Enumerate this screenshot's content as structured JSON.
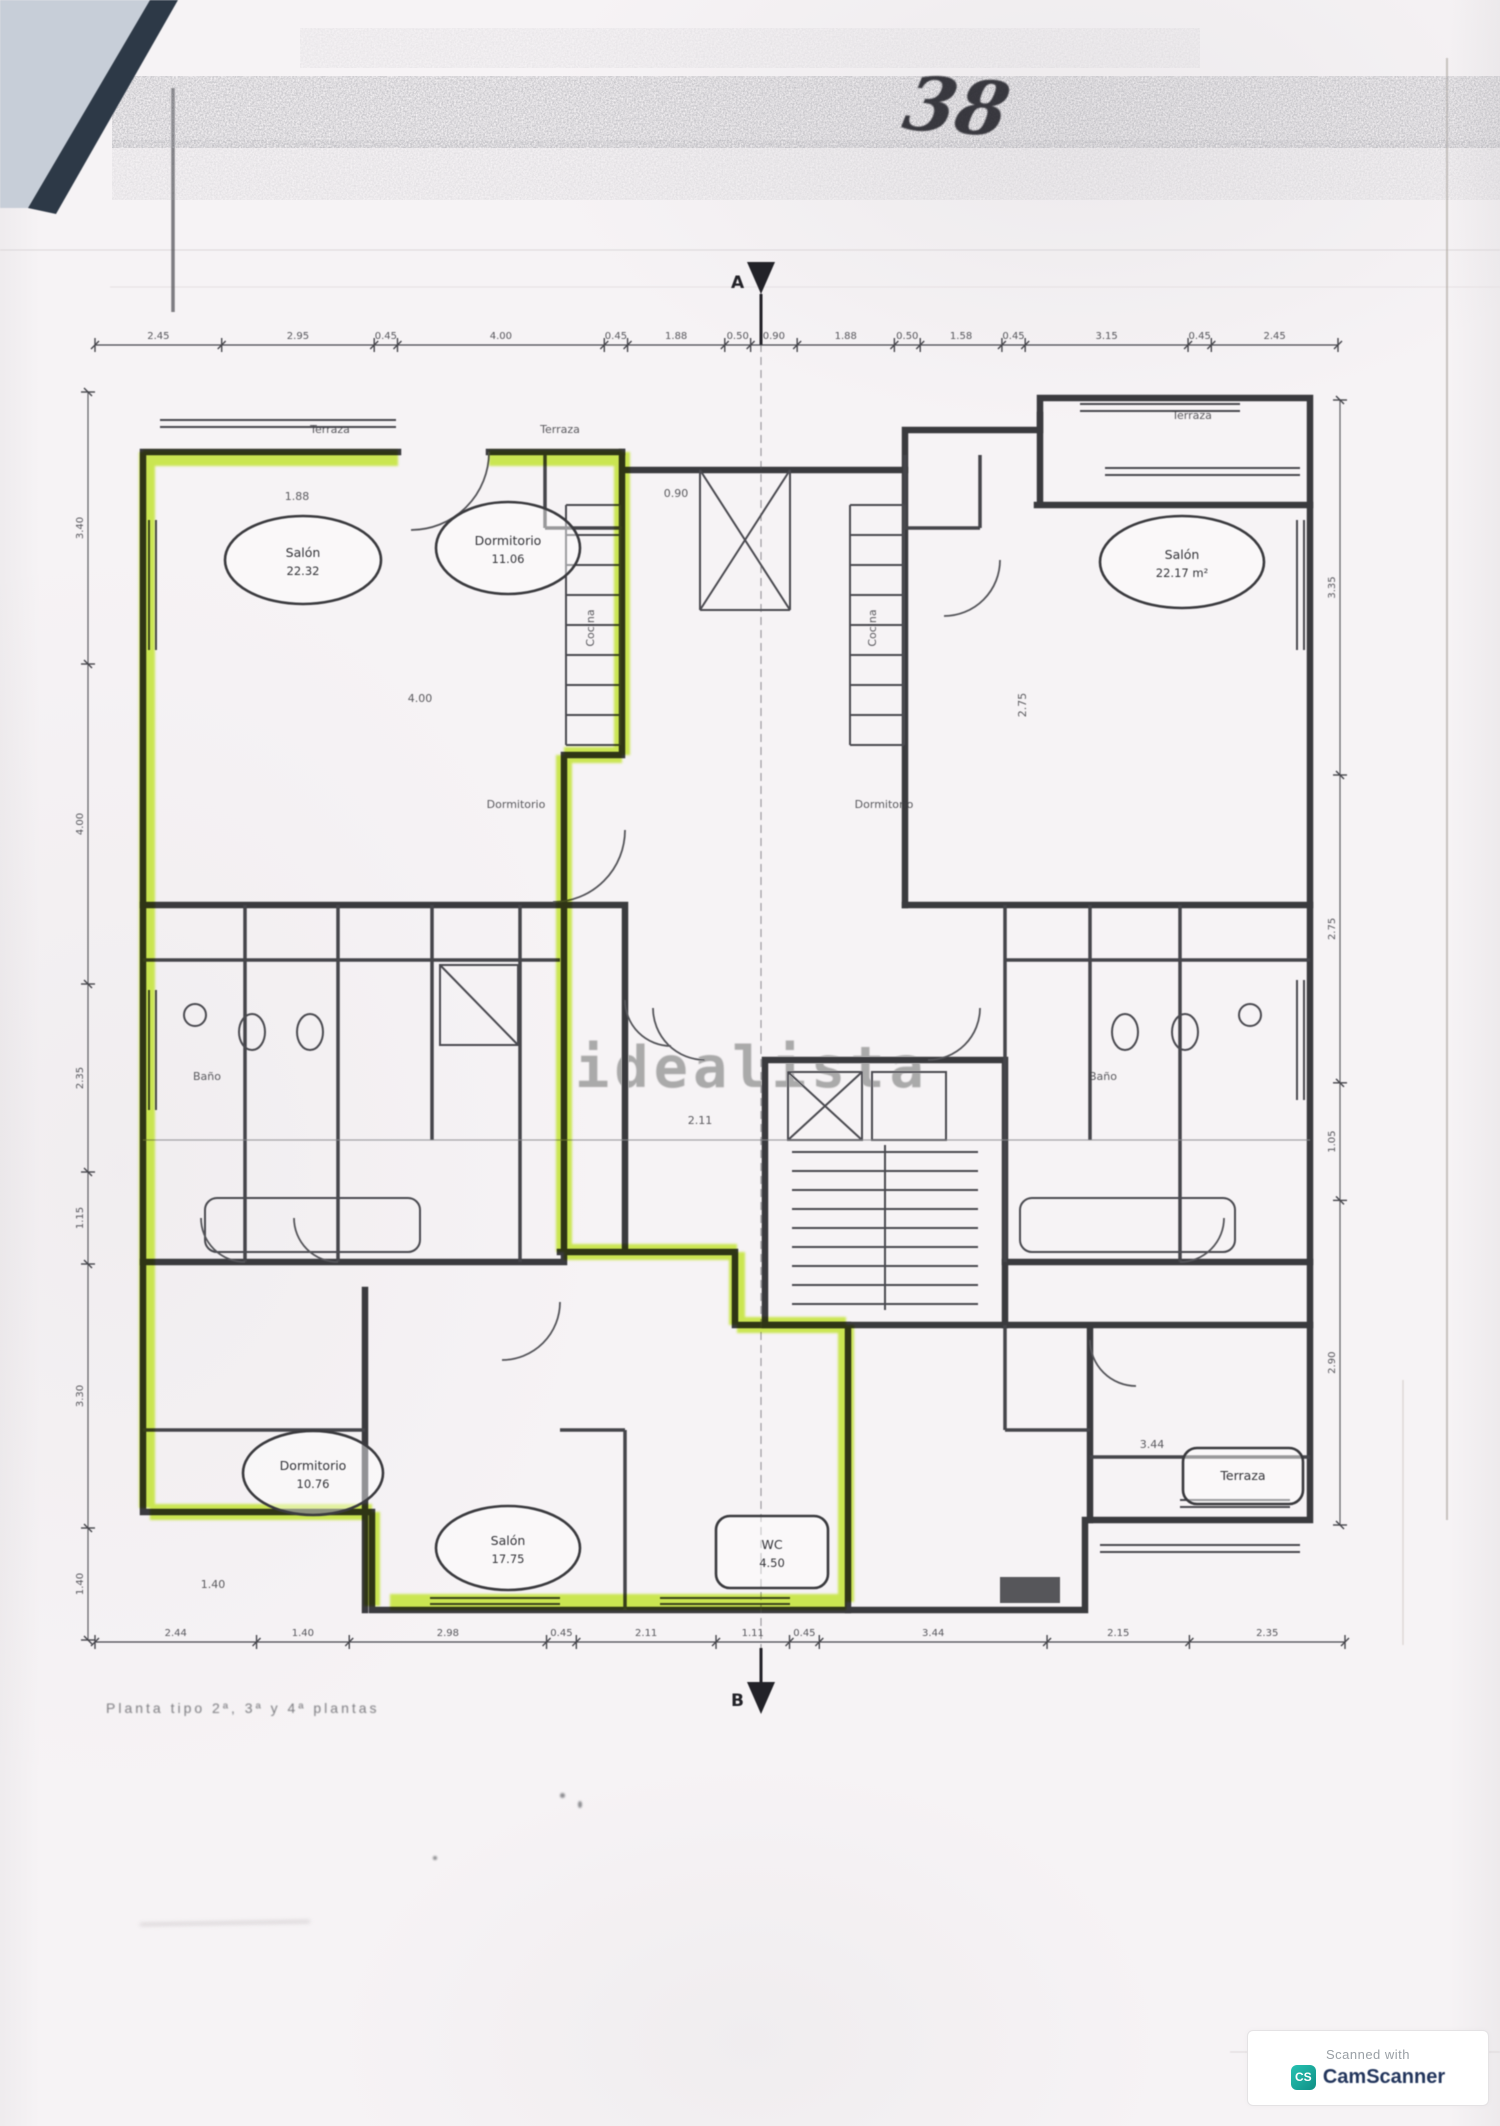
{
  "document": {
    "handwritten_mark": "38",
    "watermark": "idealista",
    "caption": "Planta tipo 2ª, 3ª y 4ª plantas",
    "section_markers": {
      "top": "A",
      "bottom": "B"
    },
    "scan_badge": {
      "prefix": "Scanned with",
      "app": "CamScanner",
      "monogram": "CS"
    }
  },
  "colors": {
    "paper": "#f6f3f5",
    "ink": "#3a3a3e",
    "highlighter": "#bfe227",
    "watermark_gray": "#9c9c9c",
    "fold_dark": "#2d3947",
    "fold_light": "#c7ced8",
    "badge_teal": "#14a79d",
    "badge_navy": "#22355c"
  },
  "plan": {
    "rooms": [
      {
        "label": "Salón",
        "area": "22.32",
        "cx": 303,
        "cy": 560,
        "rx": 78,
        "ry": 44,
        "shape": "oval"
      },
      {
        "label": "Dormitorio",
        "area": "11.06",
        "cx": 508,
        "cy": 548,
        "rx": 72,
        "ry": 46,
        "shape": "oval"
      },
      {
        "label": "Salón",
        "area": "22.17 m²",
        "cx": 1182,
        "cy": 562,
        "rx": 82,
        "ry": 46,
        "shape": "oval"
      },
      {
        "label": "Dormitorio",
        "area": "10.76",
        "cx": 313,
        "cy": 1473,
        "rx": 70,
        "ry": 42,
        "shape": "oval"
      },
      {
        "label": "Salón",
        "area": "17.75",
        "cx": 508,
        "cy": 1548,
        "rx": 72,
        "ry": 42,
        "shape": "oval"
      },
      {
        "label": "WC",
        "area": "4.50",
        "cx": 772,
        "cy": 1552,
        "rx": 56,
        "ry": 36,
        "shape": "rrect"
      },
      {
        "label": "Terraza",
        "area": "",
        "cx": 1243,
        "cy": 1476,
        "rx": 60,
        "ry": 28,
        "shape": "rrect"
      }
    ],
    "small_labels": [
      {
        "text": "Terraza",
        "x": 330,
        "y": 433,
        "rot": 0
      },
      {
        "text": "Terraza",
        "x": 560,
        "y": 433,
        "rot": 0
      },
      {
        "text": "Terraza",
        "x": 1192,
        "y": 419,
        "rot": 0
      },
      {
        "text": "Cocina",
        "x": 594,
        "y": 628,
        "rot": -90
      },
      {
        "text": "Cocina",
        "x": 876,
        "y": 628,
        "rot": -90
      },
      {
        "text": "Baño",
        "x": 207,
        "y": 1080,
        "rot": 0
      },
      {
        "text": "Baño",
        "x": 1103,
        "y": 1080,
        "rot": 0
      },
      {
        "text": "Dormitorio",
        "x": 516,
        "y": 808,
        "rot": 0
      },
      {
        "text": "Dormitorio",
        "x": 884,
        "y": 808,
        "rot": 0
      },
      {
        "text": "1.88",
        "x": 297,
        "y": 500,
        "rot": 0
      },
      {
        "text": "0.90",
        "x": 676,
        "y": 497,
        "rot": 0
      },
      {
        "text": "4.00",
        "x": 420,
        "y": 702,
        "rot": 0
      },
      {
        "text": "2.75",
        "x": 1026,
        "y": 705,
        "rot": -90
      },
      {
        "text": "2.11",
        "x": 700,
        "y": 1124,
        "rot": 0
      },
      {
        "text": "3.44",
        "x": 1152,
        "y": 1448,
        "rot": 0
      },
      {
        "text": "1.40",
        "x": 213,
        "y": 1588,
        "rot": 0
      }
    ],
    "dim_chains": {
      "top": {
        "orient": "h",
        "y": 345,
        "x0": 95,
        "x1": 1338,
        "values": [
          "2.45",
          "2.95",
          "0.45",
          "4.00",
          "0.45",
          "1.88",
          "0.50",
          "0.90",
          "1.88",
          "0.50",
          "1.58",
          "0.45",
          "3.15",
          "0.45",
          "2.45"
        ]
      },
      "bottom": {
        "orient": "h",
        "y": 1642,
        "x0": 95,
        "x1": 1345,
        "values": [
          "2.44",
          "1.40",
          "2.98",
          "0.45",
          "2.11",
          "1.11",
          "0.45",
          "3.44",
          "2.15",
          "2.35"
        ]
      },
      "left": {
        "orient": "v",
        "x": 88,
        "y0": 392,
        "y1": 1640,
        "values": [
          "3.40",
          "4.00",
          "2.35",
          "1.15",
          "3.30",
          "1.40"
        ]
      },
      "right": {
        "orient": "v",
        "x": 1340,
        "y0": 400,
        "y1": 1525,
        "values": [
          "3.35",
          "2.75",
          "1.05",
          "2.90"
        ]
      }
    }
  }
}
